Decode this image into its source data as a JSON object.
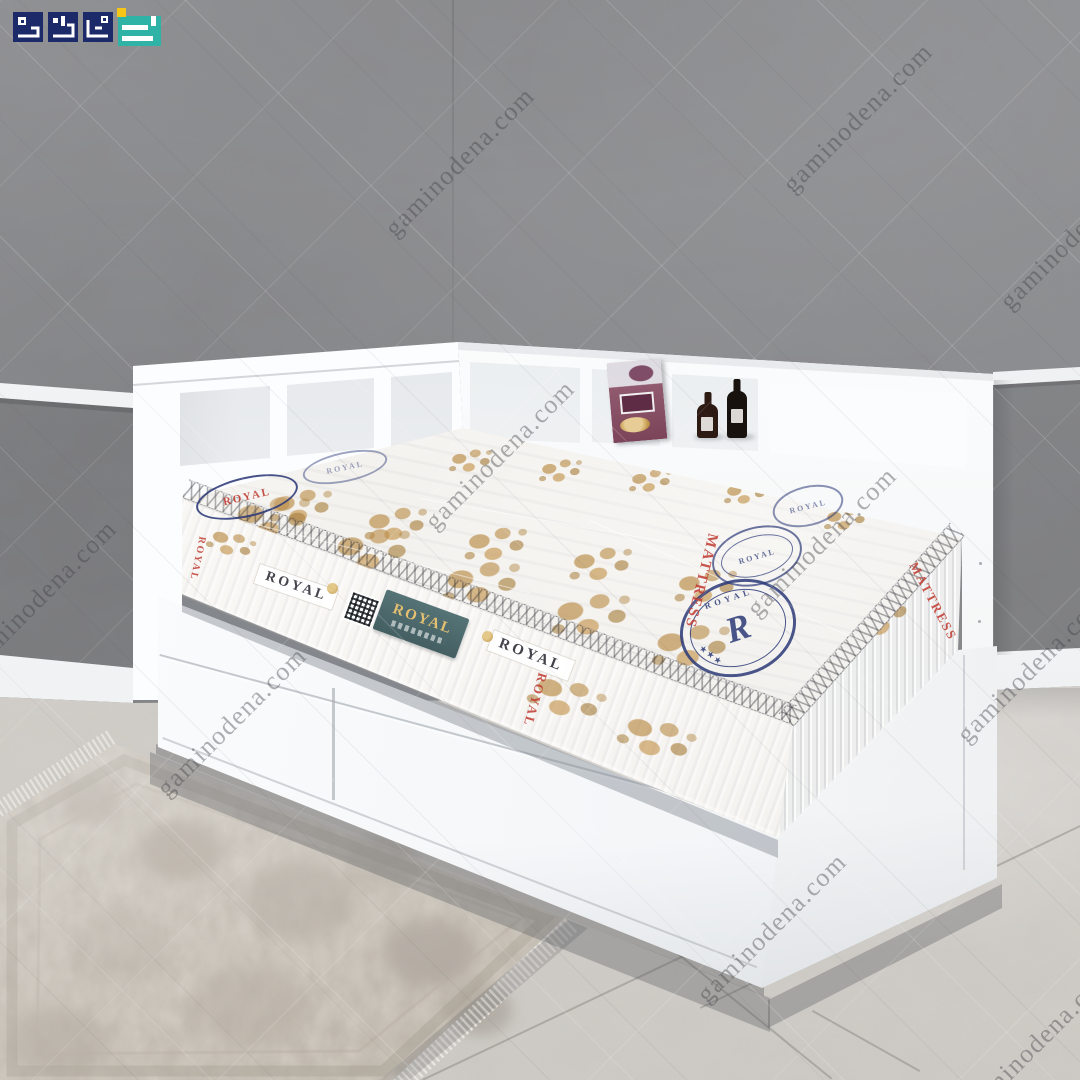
{
  "site": {
    "logo_alt": "Gamino Dena",
    "logo_navy": "#1c2a6a",
    "logo_teal": "#2eb3a6",
    "logo_yellow": "#f5c518"
  },
  "room": {
    "wall_color": "#8a8b8d",
    "trim_color": "#f4f5f6",
    "floor_color": "#d5d2cd",
    "bed_color": "#fbfcfd"
  },
  "mattress": {
    "brand": "ROYAL",
    "side_label_1": "ROYAL",
    "side_label_2": "ROYAL",
    "tag_text": "ROYAL",
    "red_text_1": "MATTRESS",
    "red_text_2": "ROYAL",
    "red_text_3": "MATTRESS",
    "oval_text": "ROYAL",
    "stamp_word": "ROYAL",
    "stamp_letter": "R",
    "stamp_stars": "★★★",
    "gold": "#c9a158",
    "stamp_navy": "#2c3a78",
    "label_red": "#c03a31",
    "tag_teal": "#47666a"
  },
  "watermarks": {
    "text": "gaminodena.com",
    "positions": [
      [
        460,
        162
      ],
      [
        858,
        118
      ],
      [
        1075,
        235
      ],
      [
        42,
        595
      ],
      [
        500,
        455
      ],
      [
        822,
        542
      ],
      [
        232,
        722
      ],
      [
        1032,
        668
      ],
      [
        772,
        928
      ],
      [
        1040,
        1040
      ]
    ]
  }
}
